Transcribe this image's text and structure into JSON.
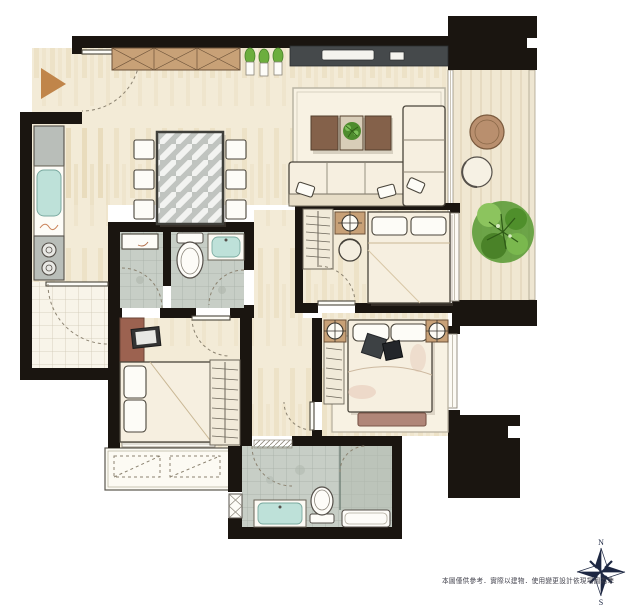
{
  "page": {
    "background": "#ffffff"
  },
  "plan": {
    "type": "apartment floor plan, hand-rendered marker style",
    "rooms": [
      "entry",
      "kitchen",
      "dining-area",
      "living-room",
      "balcony",
      "bedroom-2",
      "upper-hallway",
      "bathroom-1",
      "bathroom-2",
      "bedroom-3",
      "lower-hallway",
      "utility-balcony",
      "master-bedroom",
      "master-bathroom"
    ],
    "furniture": {
      "entry": [
        "entry-direction-arrow",
        "shoe-cabinet",
        "potted-plants"
      ],
      "dining": [
        "glass-dining-table",
        "dining-chairs-x6"
      ],
      "kitchen": [
        "refrigerator",
        "kitchen-sink",
        "two-burner-cooktop",
        "tiled-floor"
      ],
      "living": [
        "tv-console",
        "wall-tv",
        "area-rug",
        "coffee-table",
        "table-plant",
        "sofa",
        "chaise"
      ],
      "balcony": [
        "round-table",
        "lounge-chair",
        "tree",
        "wood-deck"
      ],
      "bedroom2": [
        "double-bed",
        "nightstand",
        "table-lamp",
        "round-stool",
        "wardrobe",
        "window"
      ],
      "bedroom3": [
        "bed",
        "dresser",
        "tv",
        "wardrobe",
        "window"
      ],
      "master_bedroom": [
        "double-bed",
        "nightstand-left",
        "nightstand-right",
        "table-lamp-left",
        "table-lamp-right",
        "throw-pillows",
        "foot-bench",
        "area-rug",
        "wardrobe",
        "window"
      ],
      "bathroom1": [
        "toilet",
        "sink",
        "tiled-floor"
      ],
      "bathroom2": [
        "vanity-counter",
        "tiled-floor"
      ],
      "master_bathroom": [
        "vanity-sink",
        "toilet",
        "bathtub-shower",
        "glass-partition",
        "louver-vent",
        "hatched-threshold"
      ],
      "utility_balcony": [
        "ac-unit-pad-1",
        "ac-unit-pad-2"
      ]
    }
  },
  "compass": {
    "north_label": "N",
    "south_label": "S"
  },
  "footer": {
    "disclaimer": "本圖僅供參考．實際以建物．使用變更設計依現場圖為準"
  },
  "colors": {
    "page_bg": "#ffffff",
    "wall_black": "#1a1510",
    "floor_cream": "#f3ebd7",
    "floor_deep": "#e3d3ae",
    "kitchen_tile": "#f8f4e9",
    "bath_tile": "#c7cec6",
    "teal": "#bee1d9",
    "wood_tan": "#c8a177",
    "wood_dark": "#84614a",
    "wood_red": "#9c6250",
    "charcoal": "#45494b",
    "linen": "#f6efe0",
    "rug": "#f8f2e3",
    "arrow_tan": "#c0854a",
    "plant_green": "#6cae3e",
    "tree_green": "#5d9c38",
    "compass_navy": "#1d2742",
    "line_dark": "#4a453b",
    "window_white": "#fcfaf4",
    "balcony_wood": "#f0e7d2",
    "glass_gray": "#c0c4c0"
  }
}
